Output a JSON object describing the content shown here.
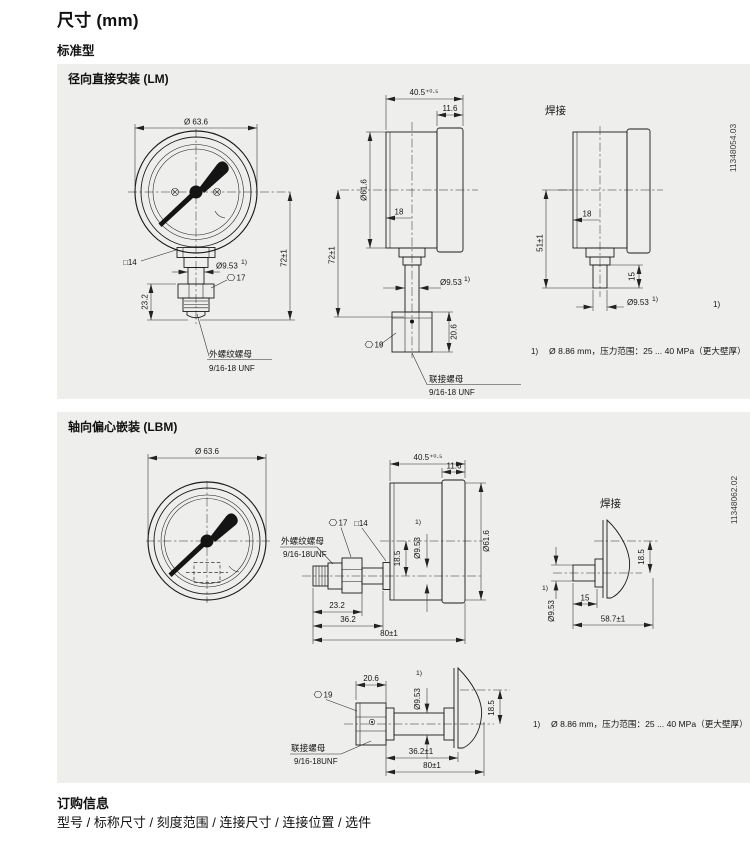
{
  "page": {
    "title": "尺寸 (mm)",
    "subtitle": "标准型",
    "order_heading": "订购信息",
    "order_line": "型号 / 标称尺寸 / 刻度范围 / 连接尺寸 / 连接位置 / 选件"
  },
  "colors": {
    "panel_bg": "#eeeeec",
    "line": "#1b1b1b"
  },
  "lm": {
    "title": "径向直接安装 (LM)",
    "doc_id": "11348054.03",
    "weld": "焊接",
    "fn_ref": "1)",
    "fn_text": "Ø 8.86 mm，压力范围：25 ... 40 MPa（更大壁厚）",
    "front": {
      "dia": "Ø 63.6",
      "sq": "□14",
      "stem_dia": "Ø9.53",
      "ref": "1)",
      "hex": "17",
      "len": "23.2",
      "h": "72±1",
      "lbl1": "外螺纹螺母",
      "lbl2": "9/16-18 UNF"
    },
    "side": {
      "d": "40.5⁺⁰·⁵",
      "bezel": "11.6",
      "dia": "Ø61.6",
      "off": "18",
      "h": "72±1",
      "stem_dia": "Ø9.53",
      "ref": "1)",
      "hex": "19",
      "nut": "20.6",
      "lbl1": "联接螺母",
      "lbl2": "9/16-18 UNF"
    },
    "wld": {
      "off": "18",
      "h": "51±1",
      "len": "15",
      "stem_dia": "Ø9.53",
      "ref": "1)"
    }
  },
  "lbm": {
    "title": "轴向偏心嵌装 (LBM)",
    "doc_id": "11348062.02",
    "weld": "焊接",
    "fn_ref": "1)",
    "fn_text": "Ø 8.86 mm，压力范围：25 ... 40 MPa（更大壁厚）",
    "front": {
      "dia": "Ø 63.6",
      "lbl1": "外螺纹螺母",
      "lbl2": "9/16-18UNF"
    },
    "side": {
      "d": "40.5⁺⁰·⁵",
      "bezel": "11.6",
      "dia": "Ø61.6",
      "hex": "17",
      "sq": "□14",
      "ref": "1)",
      "stem_dia": "Ø9.53",
      "ecc": "18.5",
      "l1": "23.2",
      "l2": "36.2",
      "total": "80±1"
    },
    "wld": {
      "ecc": "18.5",
      "ref": "1)",
      "stem_dia": "Ø9.53",
      "len": "15",
      "total": "58.7±1"
    },
    "bottom": {
      "hex": "19",
      "nut": "20.6",
      "ref": "1)",
      "stem_dia": "Ø9.53",
      "ecc": "18.5",
      "len": "36.2±1",
      "total": "80±1",
      "lbl1": "联接螺母",
      "lbl2": "9/16-18UNF"
    }
  }
}
